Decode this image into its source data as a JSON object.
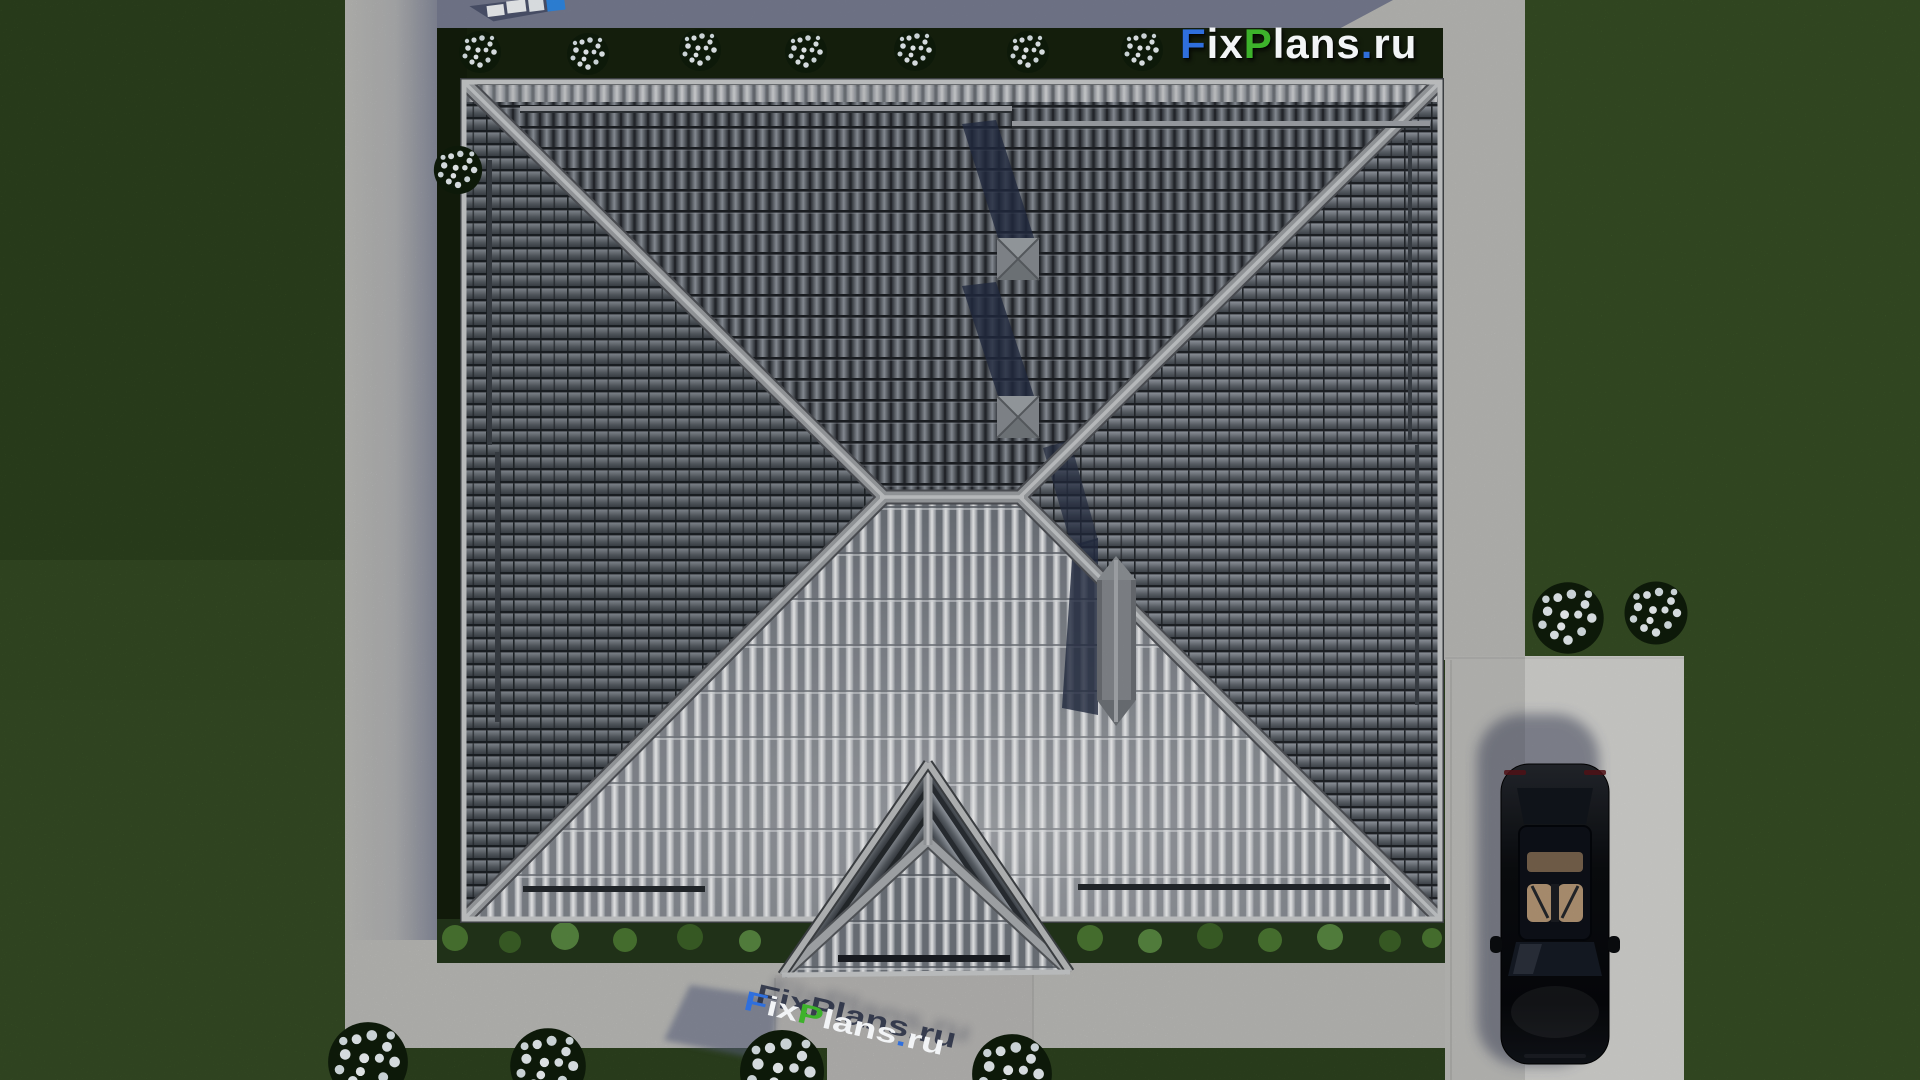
{
  "scene": {
    "objects": [
      "lawn",
      "perimeter-walkway",
      "driveway",
      "hedge-beds",
      "flower-bushes",
      "hip-roof",
      "porch-roof",
      "chimney",
      "roof-vents",
      "snow-guard-rails",
      "parked-car",
      "logo-watermark",
      "ground-3d-watermark",
      "partial-watermark-top"
    ],
    "colors": {
      "grass": "#4b6b33",
      "grass_shadow": "#3a5727",
      "concrete": "#cdcdca",
      "concrete_shadow": "#6e7389",
      "hedge_dark": "#16210e",
      "hedge_lit": "#2c4520",
      "roof_tile_dark": "#4e545b",
      "roof_tile_gap": "#1f2226",
      "roof_ribs_light": "#eef0f1",
      "ridge": "#9b9ea2",
      "vent": "#868b90",
      "chimney": "#83878c",
      "shadow_navy": "#232c42",
      "car_body": "#0b0d10",
      "car_interior": "#b29574",
      "flowers": "#e8eef0",
      "logo_blue": "#2f6fdd",
      "logo_green": "#3db22b",
      "logo_white": "#f2f4f6"
    }
  },
  "logo": {
    "f": "F",
    "ix": "ix",
    "p": "P",
    "lans": "lans",
    "dot": ".",
    "ru": "ru"
  },
  "ground_watermark": {
    "f": "F",
    "ix": "ix",
    "p": "P",
    "lans": "lans",
    "dot": ".",
    "ru": "ru"
  }
}
